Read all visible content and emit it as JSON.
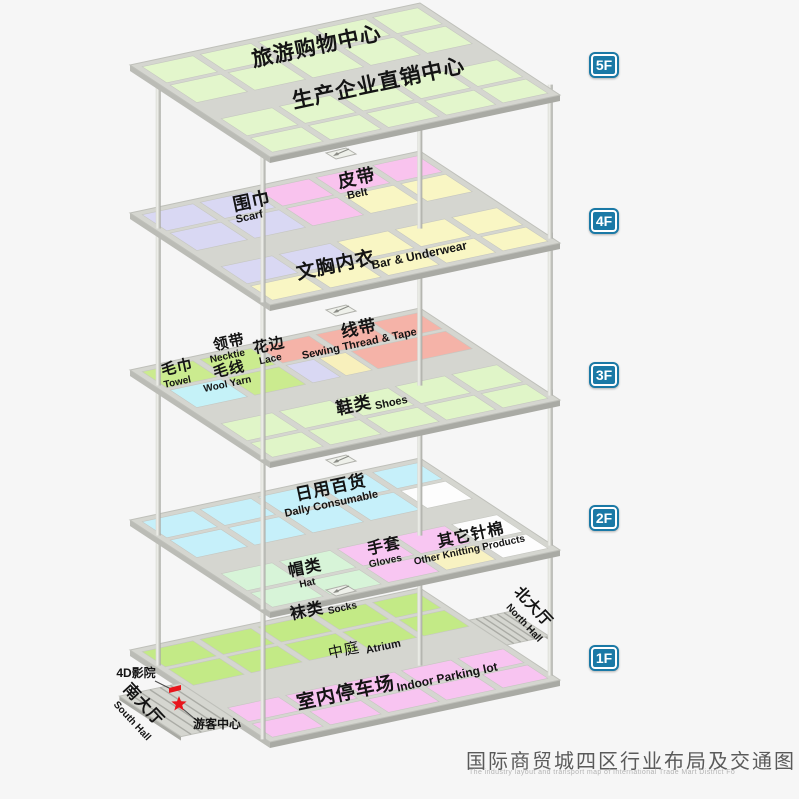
{
  "page": {
    "background": "#f6f6f6",
    "title": "国际商贸城四区行业布局及交通图",
    "subtitle": "The industry layout and transport map of International Trade Mart District Fo"
  },
  "colors": {
    "plate": "#d5d6d0",
    "plate_edge": "#bfc0ba",
    "side_light": "#bbbcb6",
    "side_dark": "#a9aaa4",
    "tile_stroke": "#c6c7c1",
    "stripe": "#aaaba5",
    "ink": "#141414",
    "leader": "#4a4a4a",
    "red": "#e8151c",
    "badge": "#1a79a6",
    "notch_fill": "#eef0ea",
    "notch_edge": "#b0b1ab",
    "arrow": "#8a8b85",
    "g5": "#e3f6cc",
    "lav": "#d9d8f3",
    "pnk": "#f9c3ee",
    "yel": "#f9f6c4",
    "sal": "#f5b3a8",
    "cyn3": "#c5f2f8",
    "wgr": "#cbeb8f",
    "yel3": "#f8f0bc",
    "shoe": "#e0f5c8",
    "cyn2": "#c6f0fa",
    "hgr": "#d7f4d8",
    "gpk": "#f8c6f2",
    "yel2": "#f8f2c2",
    "wht": "#fdfdfd",
    "sg": "#c3ea86",
    "ppk": "#f8c4f1"
  },
  "geometry": {
    "ox": 130,
    "ax": 290,
    "ay": -62,
    "bx": 140,
    "by": 92,
    "thickness": 6,
    "cols": [
      [
        0.025,
        0.2
      ],
      [
        0.225,
        0.4
      ],
      [
        0.425,
        0.6
      ],
      [
        0.625,
        0.795
      ],
      [
        0.82,
        0.975
      ]
    ]
  },
  "badges": {
    "x": 589,
    "items": [
      {
        "label": "5F",
        "y": 52
      },
      {
        "label": "4F",
        "y": 208
      },
      {
        "label": "3F",
        "y": 362
      },
      {
        "label": "2F",
        "y": 505
      },
      {
        "label": "1F",
        "y": 645
      }
    ]
  },
  "floors": [
    {
      "id": "5F",
      "oy": 65,
      "rows": [
        {
          "v": [
            0.035,
            0.21
          ],
          "cells": [
            "g5",
            "g5",
            "g5",
            "g5",
            "g5"
          ]
        },
        {
          "v": [
            0.235,
            0.425
          ],
          "cells": [
            "g5",
            "g5",
            "g5",
            "g5",
            "g5"
          ]
        },
        {
          "v": [
            0.6,
            0.785
          ],
          "cells": [
            "g5",
            "g5",
            "g5",
            "g5",
            "g5"
          ]
        },
        {
          "v": [
            0.81,
            0.965
          ],
          "cells": [
            "g5",
            "g5",
            "g5",
            "g5",
            "g5"
          ]
        }
      ],
      "labels": [
        {
          "zh": "旅游购物中心",
          "zx": 318,
          "zy": 53,
          "zs": 21
        },
        {
          "zh": "生产企业直销中心",
          "zx": 380,
          "zy": 90,
          "zs": 21
        }
      ]
    },
    {
      "id": "4F",
      "oy": 213,
      "rows": [
        {
          "v": [
            0.035,
            0.21
          ],
          "cells": [
            "lav",
            "lav",
            "pnk",
            "pnk",
            "pnk"
          ]
        },
        {
          "v": [
            0.235,
            0.425
          ],
          "cells": [
            "lav",
            "lav",
            "pnk",
            "yel",
            "yel"
          ]
        },
        {
          "v": [
            0.6,
            0.785
          ],
          "cells": [
            "lav",
            "lav",
            "yel",
            "yel",
            "yel"
          ]
        },
        {
          "v": [
            0.81,
            0.965
          ],
          "cells": [
            "yel",
            "yel",
            "yel",
            "yel",
            "yel"
          ]
        }
      ],
      "labels": [
        {
          "zh": "围巾",
          "zx": 253,
          "zy": 207,
          "zs": 18,
          "en": "Scarf",
          "ex": 250,
          "ey": 220,
          "es": 11
        },
        {
          "zh": "皮带",
          "zx": 358,
          "zy": 184,
          "zs": 18,
          "en": "Belt",
          "ex": 358,
          "ey": 197,
          "es": 11
        },
        {
          "zh": "文胸内衣",
          "zx": 337,
          "zy": 271,
          "zs": 19,
          "en": "Bar & Underwear",
          "ex": 420,
          "ey": 259,
          "es": 12
        }
      ]
    },
    {
      "id": "3F",
      "oy": 370,
      "rows": [
        {
          "v": [
            0.035,
            0.21
          ],
          "cells": [
            "wgr",
            "wgr",
            "sal",
            "sal",
            "sal"
          ]
        },
        {
          "v": [
            0.235,
            0.425
          ],
          "cells": [
            [
              0.025,
              0.2,
              "cyn3"
            ],
            [
              0.225,
              0.4,
              "wgr"
            ],
            [
              0.425,
              0.52,
              "lav"
            ],
            [
              0.54,
              0.63,
              "yel3"
            ],
            [
              0.65,
              0.975,
              "sal"
            ]
          ]
        },
        {
          "v": [
            0.6,
            0.785
          ],
          "cells": [
            "shoe",
            "shoe",
            "shoe",
            "shoe",
            "shoe"
          ]
        },
        {
          "v": [
            0.81,
            0.965
          ],
          "cells": [
            "shoe",
            "shoe",
            "shoe",
            "shoe",
            "shoe"
          ]
        }
      ],
      "labels": [
        {
          "zh": "毛巾",
          "zx": 178,
          "zy": 372,
          "zs": 15,
          "en": "Towel",
          "ex": 178,
          "ey": 385,
          "es": 10
        },
        {
          "zh": "毛线",
          "zx": 230,
          "zy": 374,
          "zs": 15,
          "en": "Wool Yarn",
          "ex": 228,
          "ey": 387,
          "es": 10
        },
        {
          "zh": "领带",
          "zx": 230,
          "zy": 347,
          "zs": 15,
          "en": "Necktie",
          "ex": 228,
          "ey": 359,
          "es": 10
        },
        {
          "zh": "花边",
          "zx": 270,
          "zy": 350,
          "zs": 15,
          "en": "Lace",
          "ex": 271,
          "ey": 362,
          "es": 10
        },
        {
          "zh": "线带",
          "zx": 360,
          "zy": 334,
          "zs": 17,
          "en": "Sewing Thread & Tape",
          "ex": 360,
          "ey": 347,
          "es": 11
        },
        {
          "zh": "鞋类",
          "zx": 355,
          "zy": 411,
          "zs": 17,
          "en": "Shoes",
          "ex": 392,
          "ey": 406,
          "es": 11
        }
      ]
    },
    {
      "id": "2F",
      "oy": 520,
      "rows": [
        {
          "v": [
            0.035,
            0.21
          ],
          "cells": [
            "cyn2",
            "cyn2",
            "cyn2",
            "cyn2",
            "cyn2"
          ]
        },
        {
          "v": [
            0.235,
            0.425
          ],
          "cells": [
            "cyn2",
            "cyn2",
            "cyn2",
            "cyn2",
            "wht"
          ]
        },
        {
          "v": [
            0.6,
            0.785
          ],
          "cells": [
            "hgr",
            "hgr",
            "gpk",
            "gpk",
            "wht"
          ]
        },
        {
          "v": [
            0.81,
            0.965
          ],
          "cells": [
            "hgr",
            "hgr",
            "gpk",
            "yel2",
            "wht"
          ]
        }
      ],
      "labels": [
        {
          "zh": "日用百货",
          "zx": 332,
          "zy": 493,
          "zs": 17,
          "en": "Dally Consumable",
          "ex": 332,
          "ey": 507,
          "es": 11
        },
        {
          "zh": "帽类",
          "zx": 306,
          "zy": 573,
          "zs": 16,
          "en": "Hat",
          "ex": 308,
          "ey": 586,
          "es": 10
        },
        {
          "zh": "手套",
          "zx": 385,
          "zy": 551,
          "zs": 16,
          "en": "Gloves",
          "ex": 386,
          "ey": 564,
          "es": 10
        },
        {
          "zh": "其它针棉",
          "zx": 472,
          "zy": 540,
          "zs": 16,
          "en": "Other Knitting Products",
          "ex": 470,
          "ey": 553,
          "es": 10
        }
      ]
    },
    {
      "id": "1F",
      "oy": 650,
      "rows": [
        {
          "v": [
            0.035,
            0.2
          ],
          "cells": [
            "sg",
            "sg",
            "sg",
            "sg",
            "sg"
          ]
        },
        {
          "v": [
            0.225,
            0.4
          ],
          "cells": [
            "sg",
            "sg",
            "sg",
            "sg",
            "sg"
          ]
        },
        {
          "v": [
            0.645,
            0.795
          ],
          "cells": [
            "ppk",
            "ppk",
            "ppk",
            "ppk",
            "ppk"
          ]
        },
        {
          "v": [
            0.82,
            0.965
          ],
          "cells": [
            "ppk",
            "ppk",
            "ppk",
            "ppk",
            "ppk"
          ]
        }
      ],
      "labels": [
        {
          "zh": "袜类",
          "zx": 308,
          "zy": 616,
          "zs": 16,
          "en": "Socks",
          "ex": 343,
          "ey": 611,
          "es": 10
        },
        {
          "zh": "中庭",
          "zx": 345,
          "zy": 655,
          "zs": 15,
          "w": 400,
          "en": "Atrium",
          "ex": 384,
          "ey": 650,
          "es": 11
        },
        {
          "zh": "室内停车场",
          "zx": 347,
          "zy": 699,
          "zs": 19,
          "en": "Indoor Parking lot",
          "ex": 448,
          "ey": 681,
          "es": 12
        }
      ]
    }
  ],
  "pillars": [
    {
      "u": 0.02,
      "v": 0.16
    },
    {
      "u": 0.0,
      "v": 0.95
    },
    {
      "u": 0.7,
      "v": 0.62
    },
    {
      "u": 1.0,
      "v": 0.93
    }
  ],
  "notch": {
    "dx": 196,
    "dy": -66,
    "floors": [
      "4F",
      "3F",
      "2F",
      "1F"
    ]
  },
  "ramps": [
    {
      "name": "north-hall-ramp",
      "edge": 1,
      "v1": 0.35,
      "v2": 0.62,
      "ex": 42,
      "ey": -9,
      "stripes": 6
    },
    {
      "name": "south-hall-ramp",
      "edge": 0,
      "v1": 0.36,
      "v2": 0.8,
      "ex": -61,
      "ey": 13,
      "stripes": 6
    }
  ],
  "halls": [
    {
      "id": "north-hall",
      "zh": "北大厅",
      "en": "North Hall",
      "zx": 530,
      "zy": 610,
      "ex": 522,
      "ey": 625,
      "rot": 47,
      "zs": 15,
      "es": 10
    },
    {
      "id": "south-hall",
      "zh": "南大厅",
      "en": "South Hall",
      "zx": 140,
      "zy": 708,
      "ex": 130,
      "ey": 723,
      "rot": 47,
      "zs": 16,
      "es": 10
    }
  ],
  "callouts": [
    {
      "id": "cinema-4d",
      "label": "4D影院",
      "x": 136,
      "y": 677,
      "fs": 12,
      "line": [
        [
          155,
          681
        ],
        [
          171,
          689
        ]
      ],
      "marker": "rect",
      "mx": 175,
      "my": 689
    },
    {
      "id": "visitor-center",
      "label": "游客中心",
      "x": 217,
      "y": 728,
      "fs": 12,
      "line": [
        [
          183,
          709
        ],
        [
          201,
          724
        ]
      ],
      "marker": "star",
      "mx": 179,
      "my": 704
    }
  ]
}
